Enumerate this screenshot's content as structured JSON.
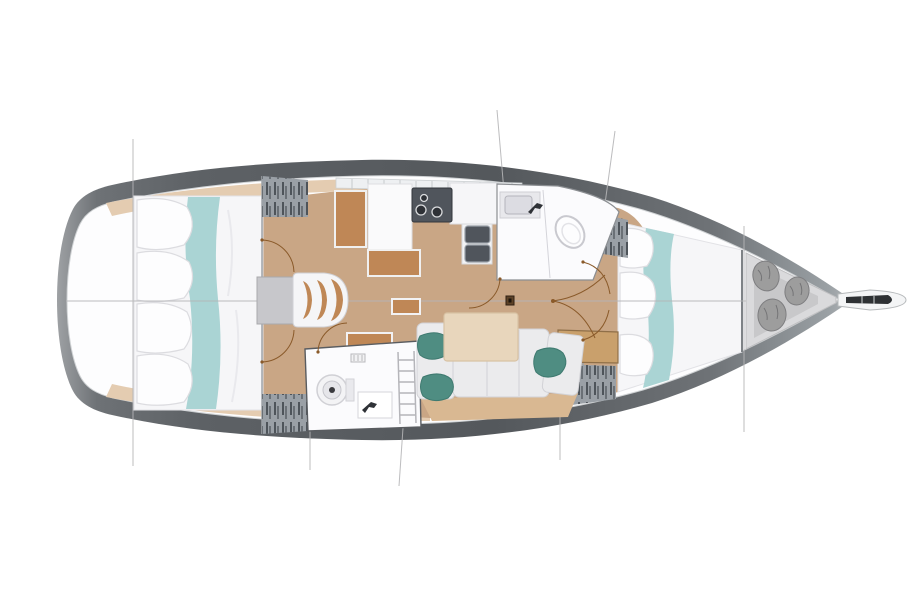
{
  "page": {
    "background": "#ffffff",
    "title": "Sailing yacht interior layout plan"
  },
  "diagram": {
    "type": "floor-plan",
    "subject": "Top-down interior layout plan of a sailing yacht",
    "bow_side": "right",
    "stern_side": "left"
  },
  "rooms": [
    {
      "id": "aft-cabin",
      "label": "Aft owner cabin with island double berth"
    },
    {
      "id": "salon",
      "label": "Salon with table and curved bench seat"
    },
    {
      "id": "galley",
      "label": "Galley with stove, twin sinks and counters"
    },
    {
      "id": "forward-head",
      "label": "Forward head with toilet and washbasin"
    },
    {
      "id": "aft-head",
      "label": "Aft head with toilet and washbasin"
    },
    {
      "id": "dinette",
      "label": "L-shaped settee with table and pillows"
    },
    {
      "id": "forward-cabin",
      "label": "Forward double berth cabin"
    },
    {
      "id": "sail-locker",
      "label": "Forepeak locker with fender bags"
    },
    {
      "id": "bowsprit",
      "label": "Bow anchor roller platform"
    }
  ],
  "features": {
    "fender_bags": 3,
    "stove_burners": 3,
    "galley_sinks": 2,
    "salon_seat_ribs": 3,
    "aft_berth_pillows": 4,
    "forward_berth_pillows": 3,
    "settee_pillows": 3,
    "heads": 2
  },
  "colors": {
    "hull_dark": "#54585c",
    "hull_mid": "#6e7276",
    "hull_light": "#9ea1a4",
    "deck_white": "#fdfdfe",
    "floor_wood": "#c9a685",
    "shelf_tan": "#e4ccb1",
    "bed_white": "#f6f6f8",
    "runner_teal": "#aad4d4",
    "pillow_white": "#fdfdfe",
    "pillow_teal": "#4f8d82",
    "furniture_wood": "#bf8756",
    "table_grey": "#c7c7cb",
    "table_wood_light": "#e8d6bc",
    "settee_grey": "#ebebed",
    "settee_base_tan": "#d9b892",
    "fixture_white": "#fbfbfd",
    "steel_dark": "#50555c",
    "locker_grey": "#9aa0a6",
    "louver_dark": "#4e545a",
    "locker_floor": "#dadadc",
    "locker_floor_inner": "#c8c8ca",
    "bag_grey": "#9d9d9d",
    "anchor_dark": "#2e3134",
    "arc_brown": "#8a5a2a",
    "line_grey": "#b5b5b7",
    "wall_grey": "#9fa3a7",
    "step_wood": "#c9a06c"
  }
}
